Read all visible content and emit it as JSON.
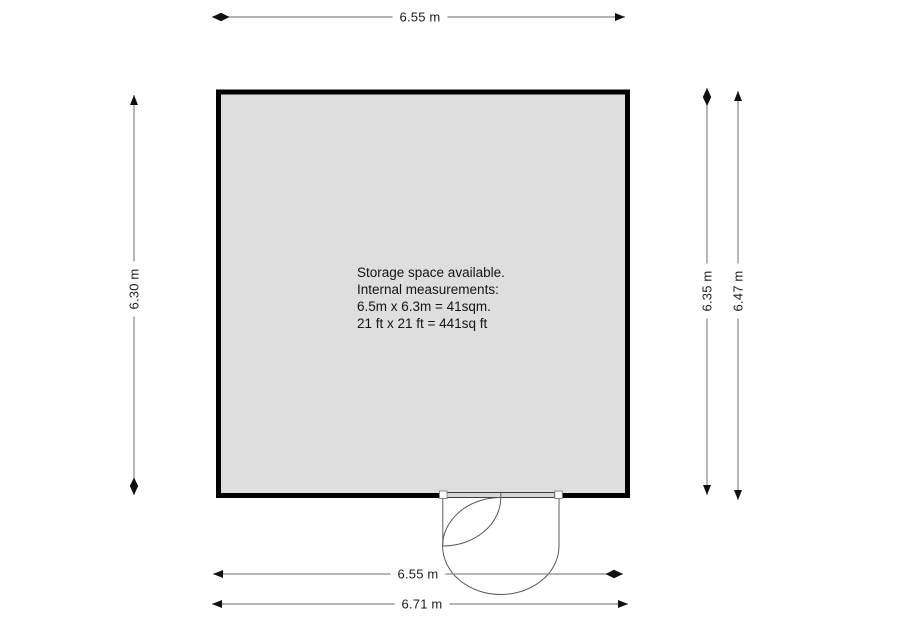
{
  "floorplan": {
    "room": {
      "description_lines": [
        "Storage space available.",
        "Internal measurements:",
        "6.5m x 6.3m = 41sqm.",
        "21 ft x 21 ft = 441sq ft"
      ]
    },
    "dimensions": {
      "top_width": "6.55 m",
      "left_height": "6.30 m",
      "right_inner_height": "6.35 m",
      "right_outer_height": "6.47 m",
      "bottom_inner_width": "6.55 m",
      "bottom_outer_width": "6.71 m"
    },
    "colors": {
      "room_fill": "#dedede",
      "wall": "#000000",
      "dimension_line": "#878787",
      "arrow": "#111111",
      "door_line": "#5a5a5a",
      "lintel_fill": "#d6d6d6"
    }
  }
}
